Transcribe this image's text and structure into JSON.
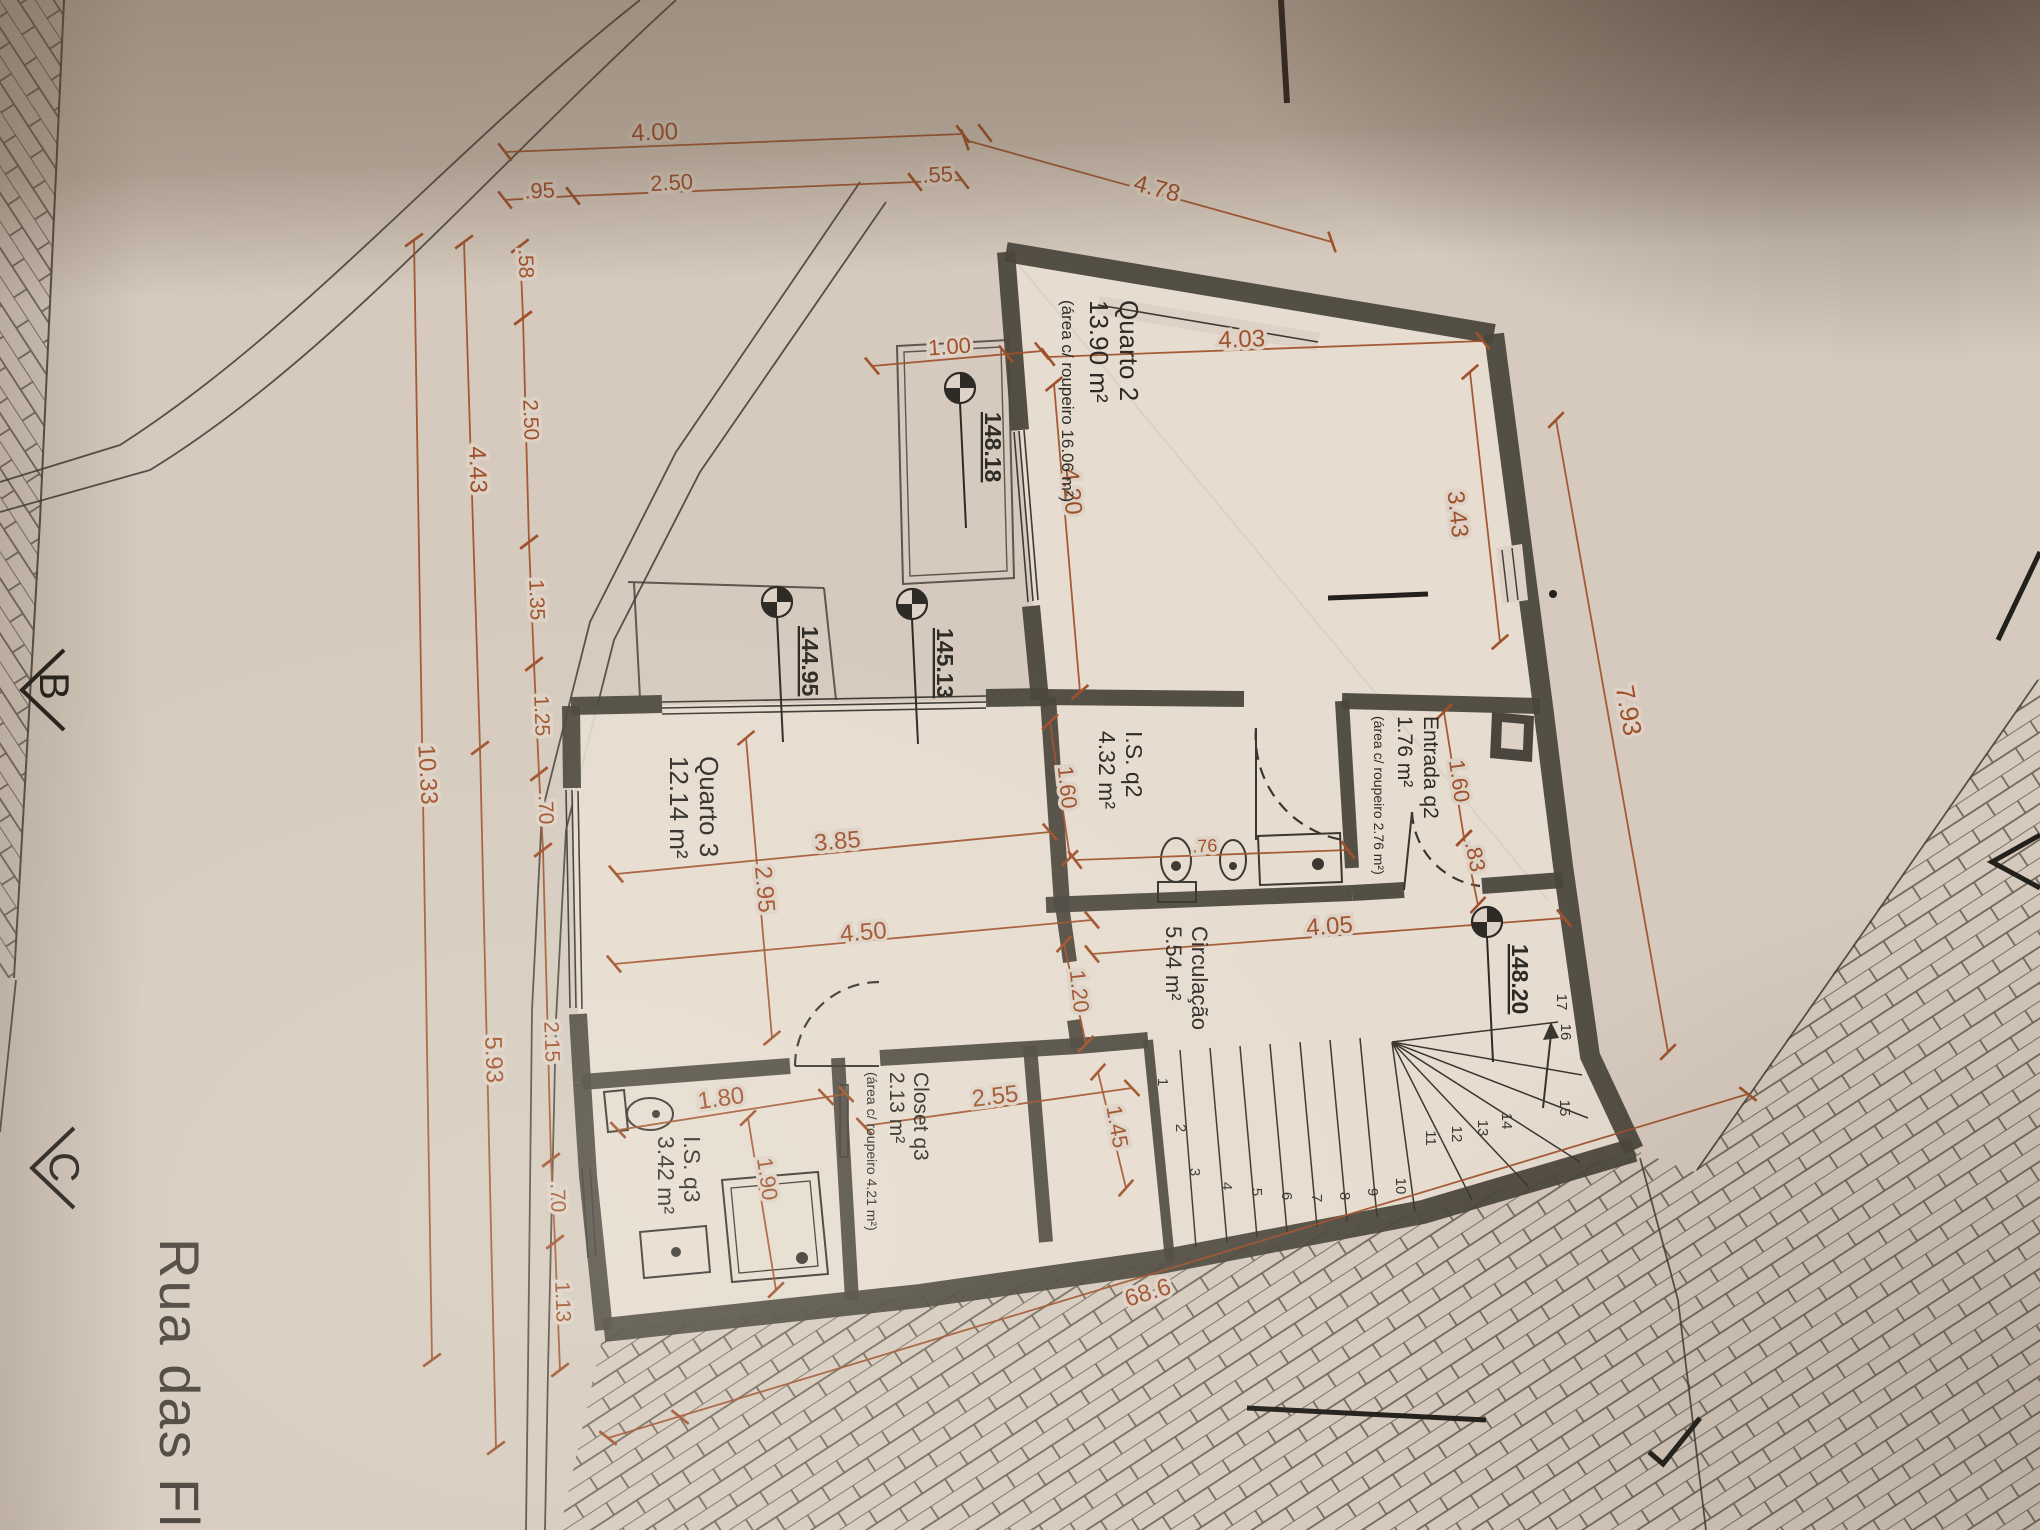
{
  "rooms": {
    "quarto2": {
      "name": "Quarto 2",
      "area": "13.90 m²",
      "note": "(área c/ roupeiro 16.06 m²)"
    },
    "entrada_q2": {
      "name": "Entrada q2",
      "area": "1.76 m²",
      "note": "(área c/ roupeiro 2.76 m²)"
    },
    "is_q2": {
      "name": "I.S. q2",
      "area": "4.32 m²"
    },
    "quarto3": {
      "name": "Quarto 3",
      "area": "12.14 m²"
    },
    "circulacao": {
      "name": "Circulação",
      "area": "5.54 m²"
    },
    "closet_q3": {
      "name": "Closet q3",
      "area": "2.13 m²",
      "note": "(área c/ roupeiro 4.21 m²)"
    },
    "is_q3": {
      "name": "I.S. q3",
      "area": "3.42 m²"
    }
  },
  "levels": {
    "l1": "148.18",
    "l2": "145.13",
    "l3": "144.95",
    "l4": "148.20"
  },
  "dims": {
    "top_total": "4.00",
    "top_s1": ".95",
    "top_s2": "2.50",
    "top_s3": ".55",
    "top_diag": "4.78",
    "terrace": "1.00",
    "l_total": "10.33",
    "l_upper": "4.43",
    "l_lower": "5.93",
    "c1": ".58",
    "c2": "2.50",
    "c3": "1.35",
    "c4": "1.25",
    "c5": ".70",
    "c6": "2.15",
    "c7": ".70",
    "c8": "1.13",
    "q2_w": "4.03",
    "q2_h": "4.20",
    "q2_r": "3.43",
    "r_total": "7.93",
    "ent_h": "1.60",
    "ent_s": ".83",
    "is2_h": "1.60",
    "is2_fix": ".76",
    "q3_a": "3.85",
    "q3_b": "2.95",
    "q3_c": "4.50",
    "circ_w": "4.05",
    "circ_h": "1.20",
    "cl_w": "2.55",
    "cl_h": "1.45",
    "is3_w": "1.80",
    "is3_h": "1.90",
    "street_front": "68.6"
  },
  "stairs": {
    "numbers": [
      "1",
      "2",
      "3",
      "4",
      "5",
      "6",
      "7",
      "8",
      "9",
      "10",
      "11",
      "12",
      "13",
      "14",
      "15",
      "16",
      "17"
    ]
  },
  "sections": {
    "b": "B",
    "c": "C"
  },
  "street": {
    "name": "Rua das Fl"
  },
  "colors": {
    "dim_line": "#a0512b",
    "ink": "#33302b",
    "wall": "#4a463d",
    "paper": "#ddd2c5"
  }
}
